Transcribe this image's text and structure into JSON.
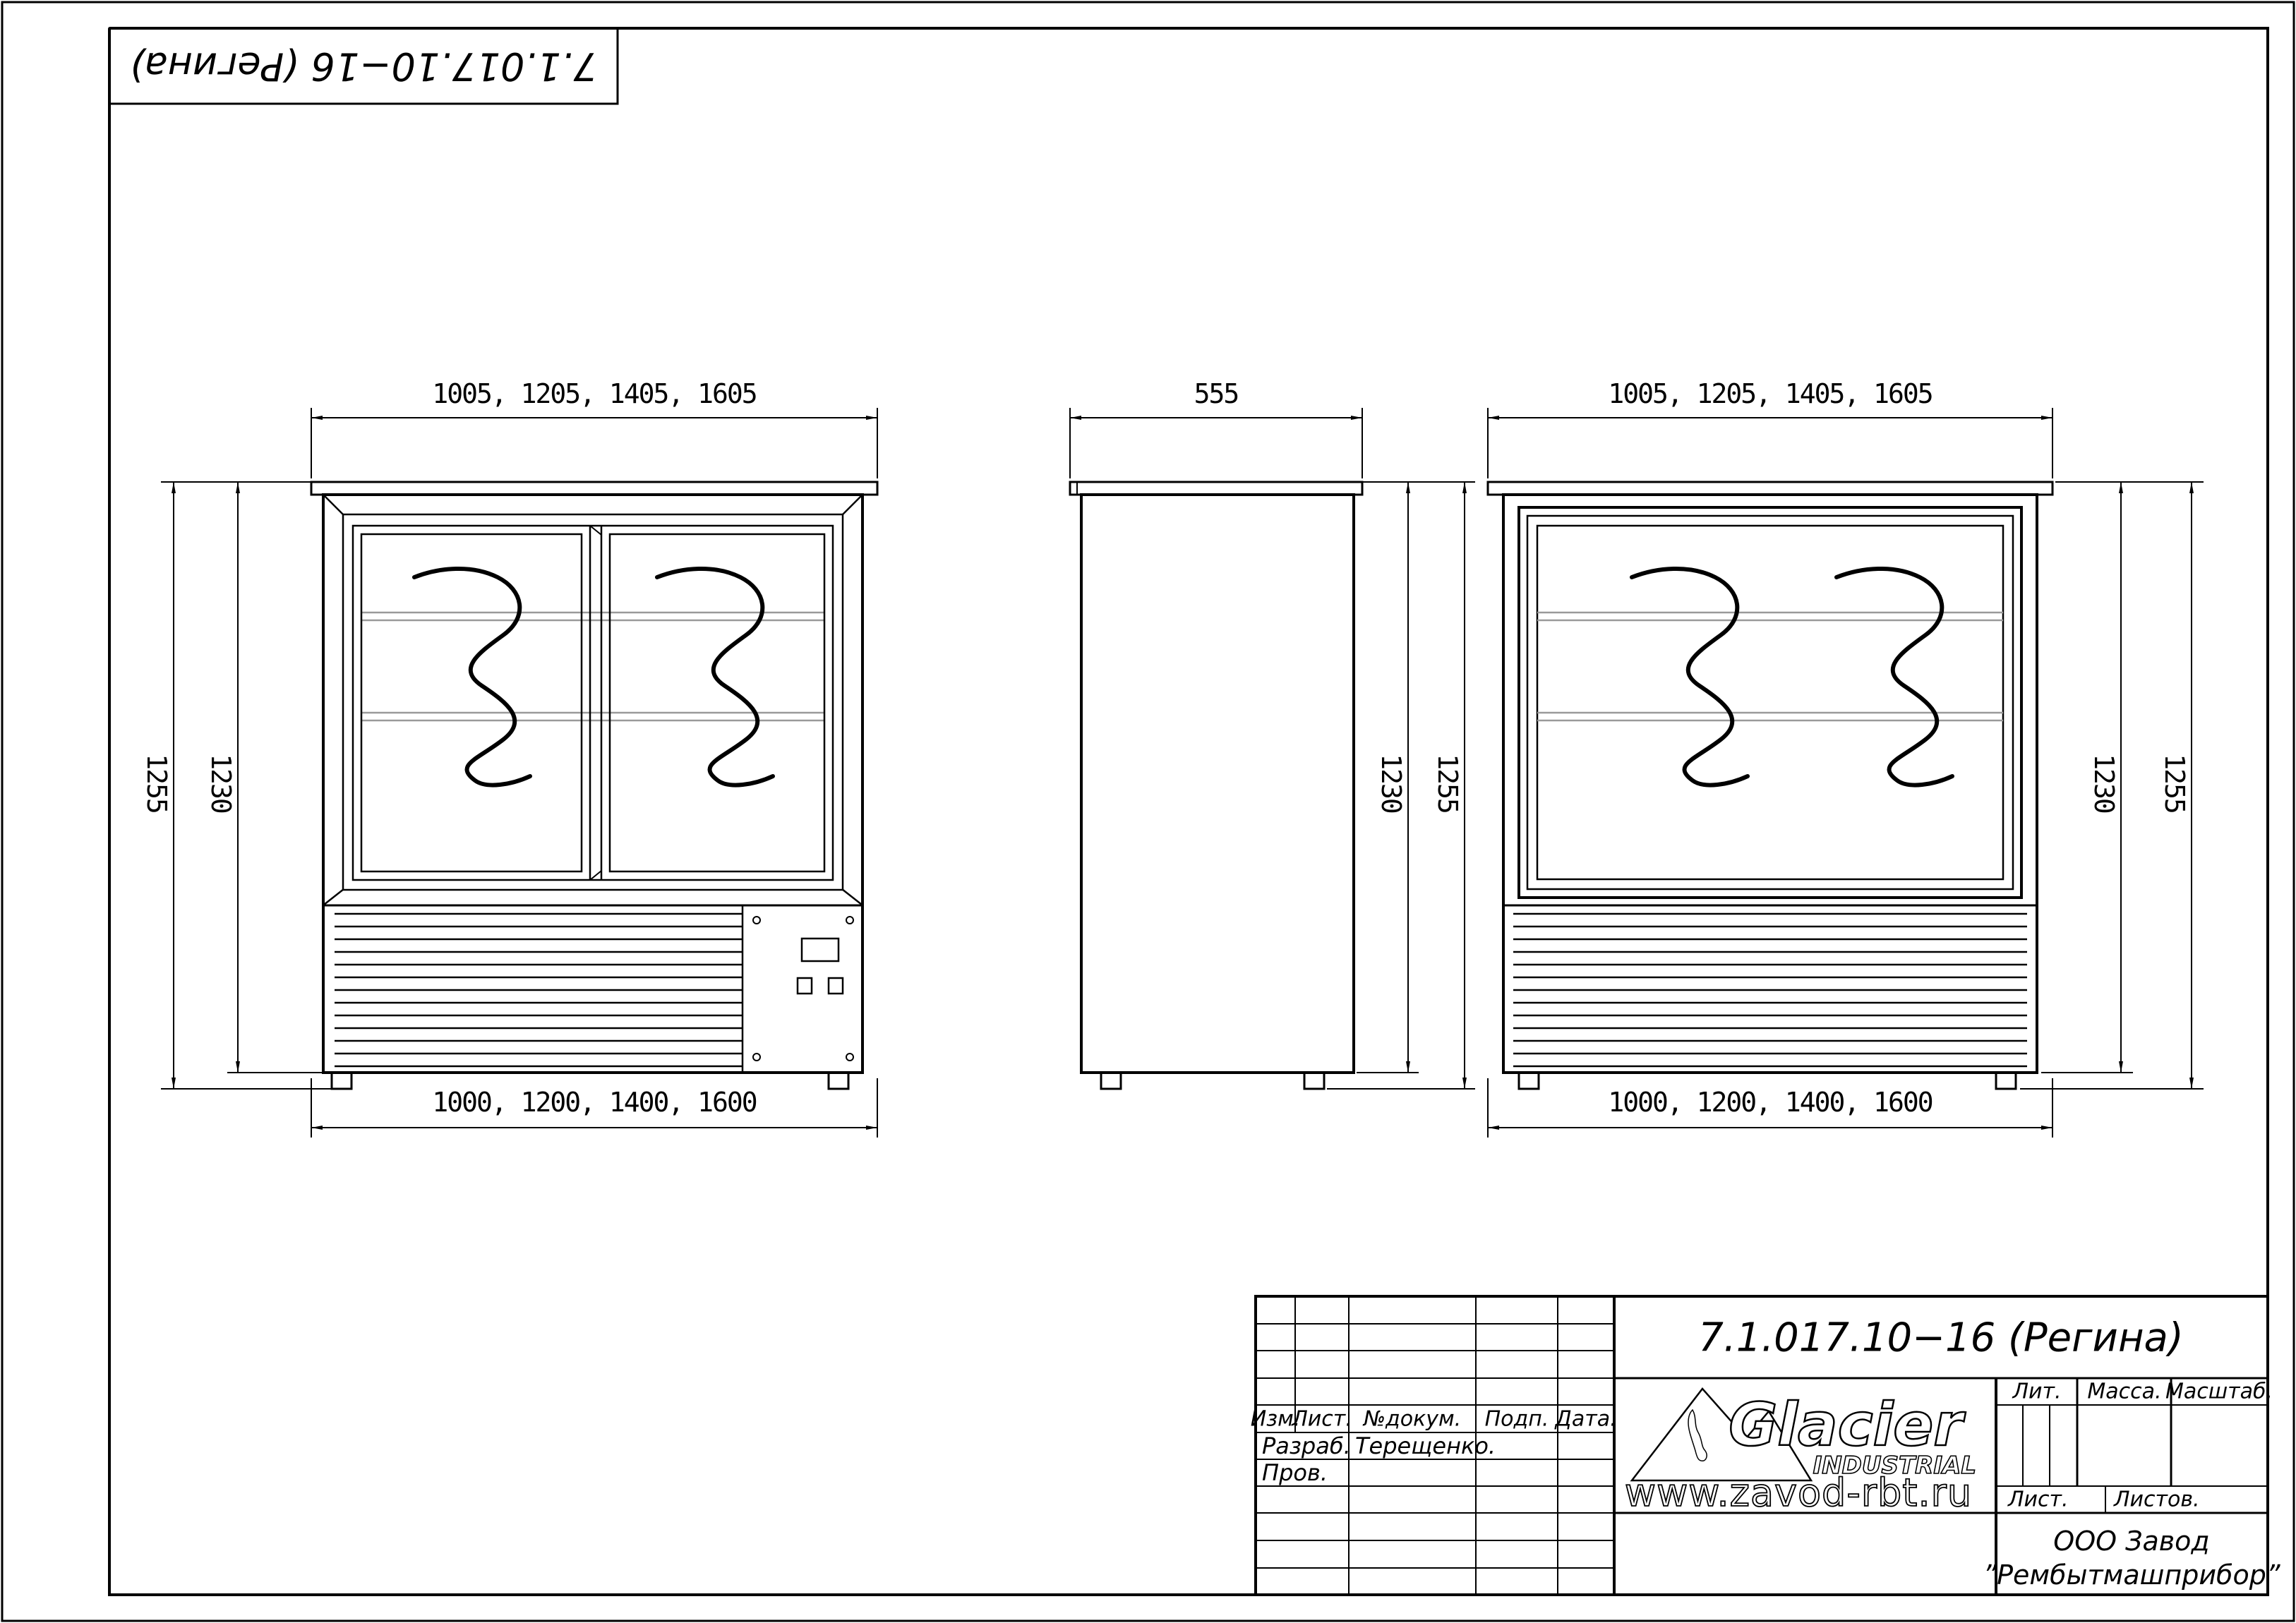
{
  "document": {
    "designation": "7.1.017.10−16 (Регина)"
  },
  "colors": {
    "ink": "#000000",
    "paper": "#ffffff",
    "shelf_line": "#9a9a9a"
  },
  "views": {
    "front": {
      "top_width_dim": "1005, 1205, 1405, 1605",
      "bottom_width_dim": "1000, 1200, 1400, 1600",
      "overall_height_dim": "1255",
      "body_height_dim": "1230"
    },
    "side": {
      "depth_dim": "555",
      "body_height_dim": "1230",
      "overall_height_dim": "1255"
    },
    "rear": {
      "top_width_dim": "1005, 1205, 1405, 1605",
      "bottom_width_dim": "1000, 1200, 1400, 1600",
      "body_height_dim": "1230",
      "overall_height_dim": "1255"
    }
  },
  "title_block": {
    "revision_headers": {
      "izm": "Изм.",
      "list": "Лист.",
      "ndokum": "№докум.",
      "podp": "Подп.",
      "data": "Дата."
    },
    "razrab_label": "Разраб.",
    "razrab_name": "Терещенко.",
    "prov_label": "Пров.",
    "lit_label": "Лит.",
    "massa_label": "Масса.",
    "masshtab_label": "Масштаб.",
    "list_label": "Лист.",
    "listov_label": "Листов.",
    "company_line1": "ООО Завод",
    "company_line2": "”Рембытмашприбор”",
    "logo": {
      "brand": "Glacier",
      "subtitle": "INDUSTRIAL",
      "website": "www.zavod-rbt.ru"
    }
  }
}
